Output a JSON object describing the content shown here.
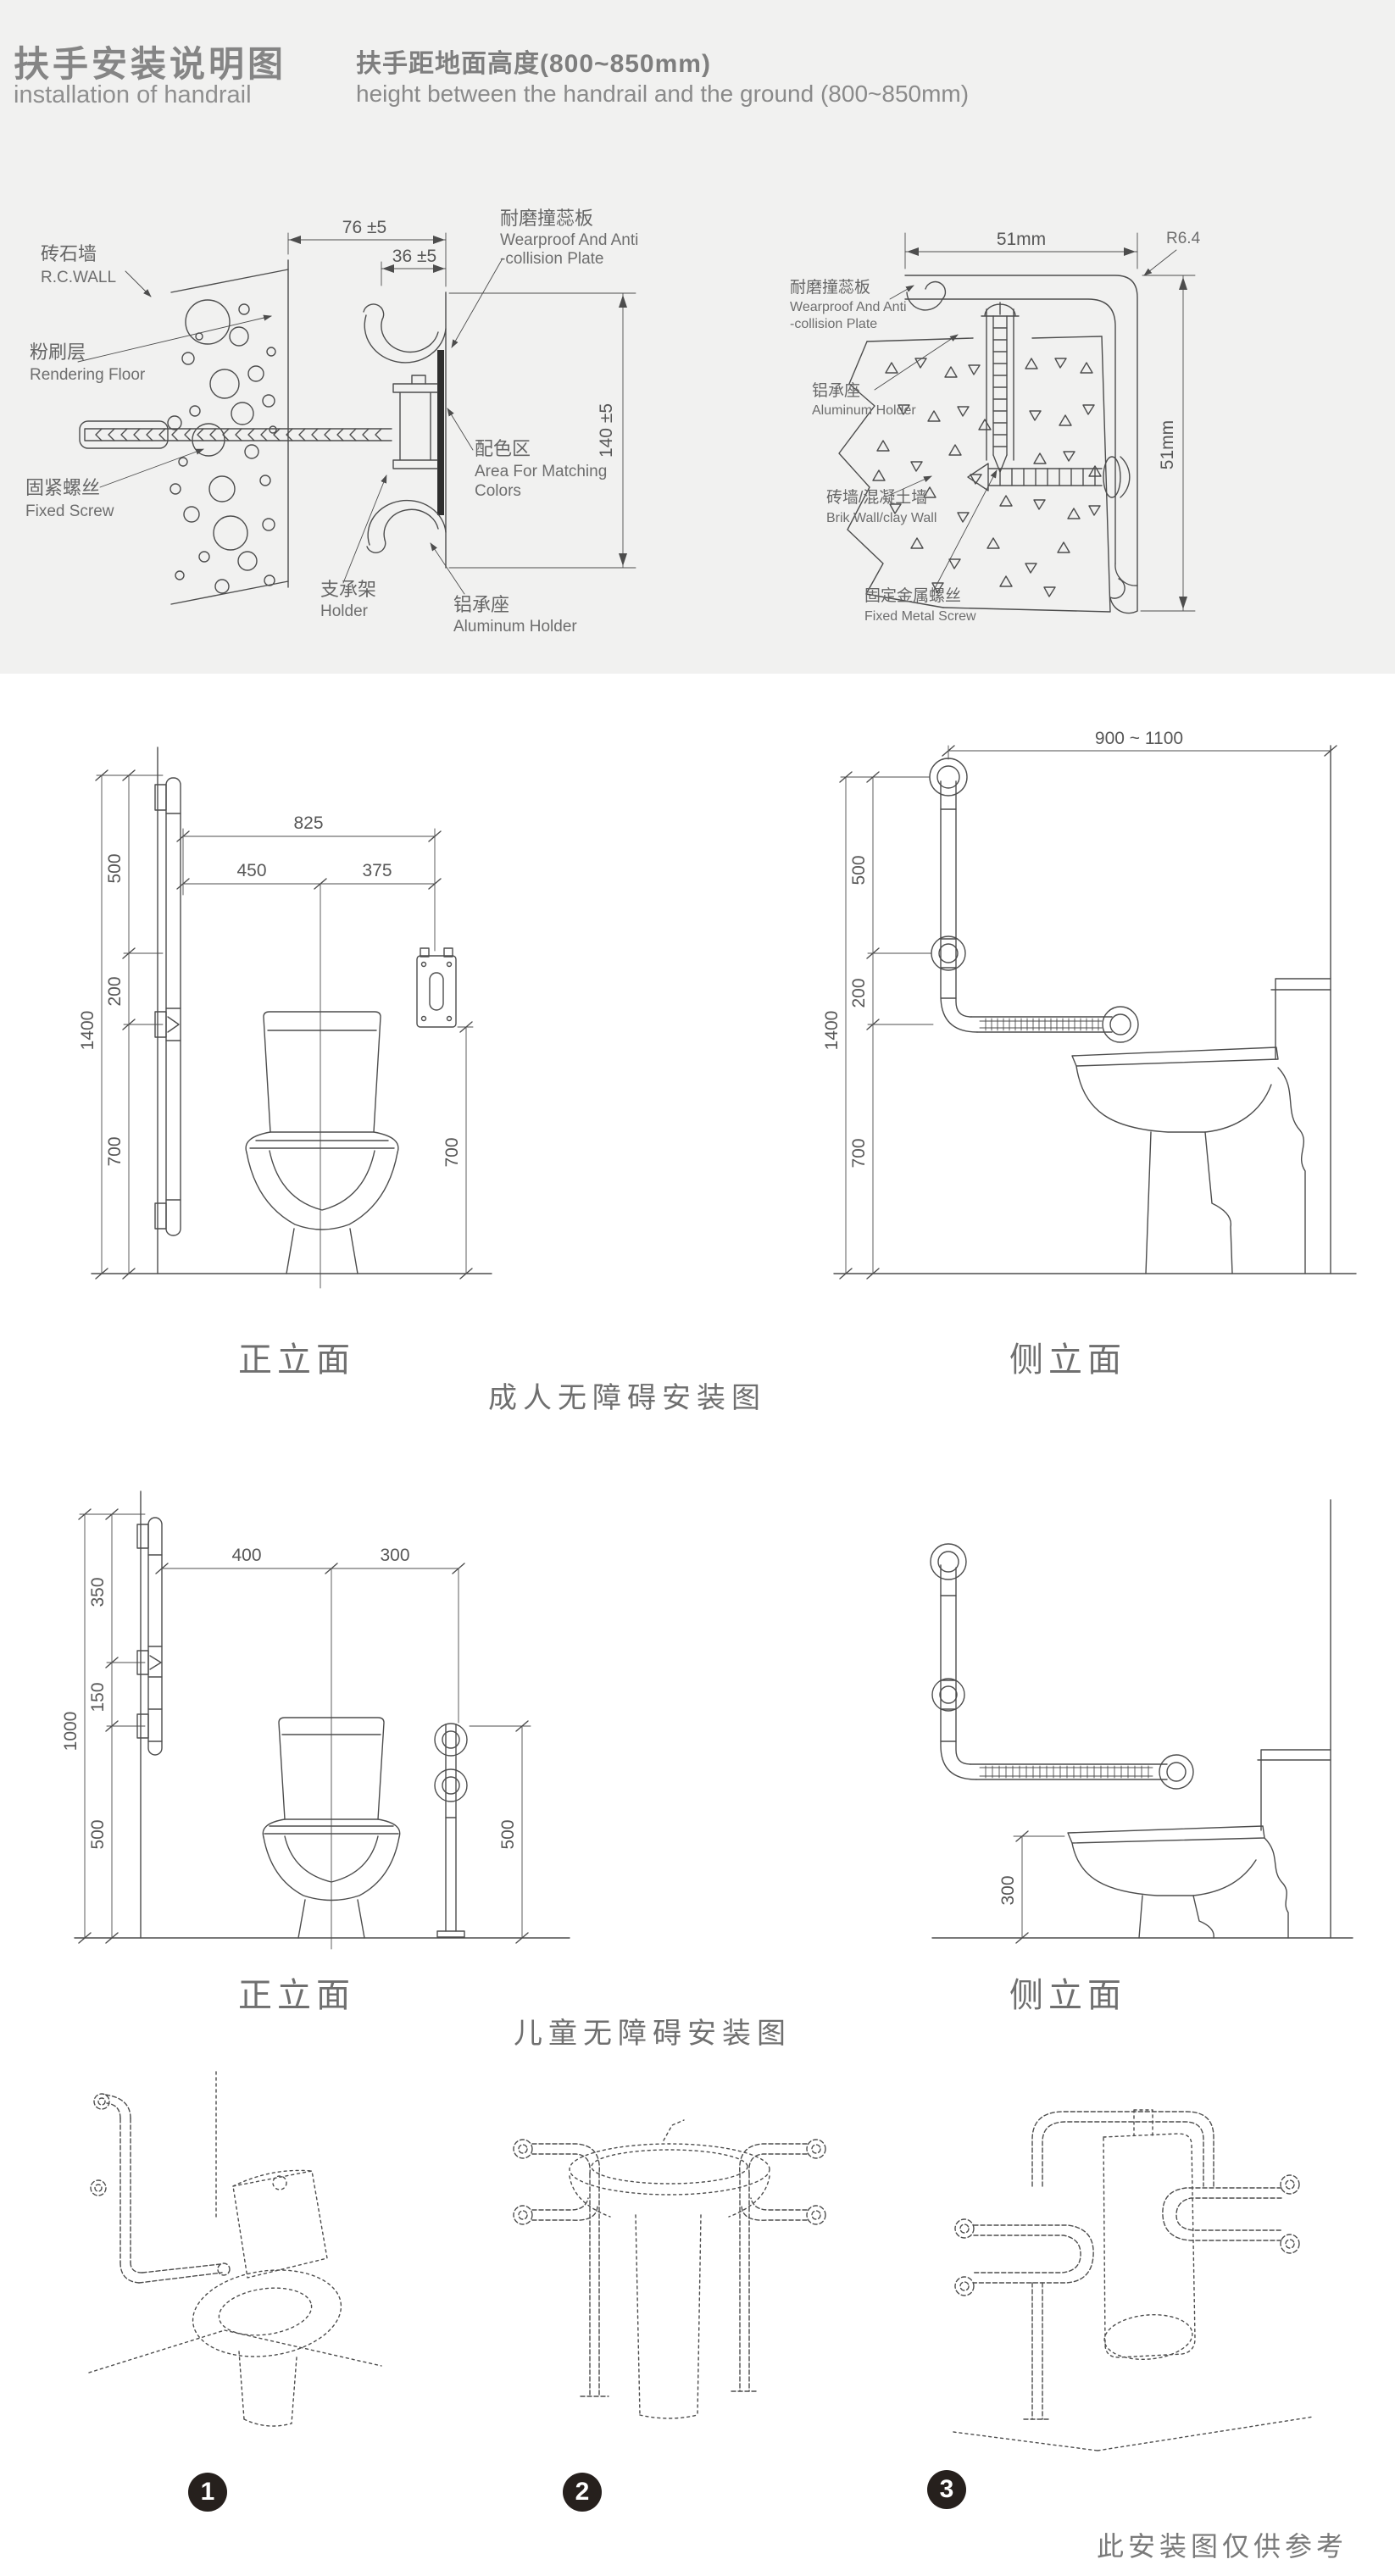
{
  "colors": {
    "band": "#f1f1f0",
    "line": "#4d4d4d",
    "label": "#666666",
    "badge": "#26201d"
  },
  "header": {
    "title_cn": "扶手安装说明图",
    "title_en": "installation of handrail",
    "subtitle_cn": "扶手距地面高度(800~850mm)",
    "subtitle_en": "height between the handrail and the ground (800~850mm)"
  },
  "profile_left": {
    "dim_width": "76 ±5",
    "dim_inner": "36 ±5",
    "dim_height": "140 ±5",
    "wall_cn": "砖石墙",
    "wall_en": "R.C.WALL",
    "render_cn": "粉刷层",
    "render_en": "Rendering Floor",
    "screw_cn": "固紧螺丝",
    "screw_en": "Fixed Screw",
    "holder_cn": "支承架",
    "holder_en": "Holder",
    "plate_cn": "耐磨撞蕊板",
    "plate_en1": "Wearproof And Anti",
    "plate_en2": "-collision Plate",
    "area_cn": "配色区",
    "area_en1": "Area For Matching",
    "area_en2": "Colors",
    "alu_cn": "铝承座",
    "alu_en": "Aluminum Holder"
  },
  "profile_right": {
    "dim_width": "51mm",
    "dim_radius": "R6.4",
    "dim_height": "51mm",
    "plate_cn": "耐磨撞蕊板",
    "plate_en1": "Wearproof And Anti",
    "plate_en2": "-collision Plate",
    "alu_cn": "铝承座",
    "alu_en": "Aluminum Holder",
    "wall_cn": "砖墙/混凝土墙",
    "wall_en": "Brik Wall/clay Wall",
    "screw_cn": "固定金属螺丝",
    "screw_en": "Fixed Metal Screw"
  },
  "adult": {
    "title": "成人无障碍安装图",
    "front_label": "正立面",
    "side_label": "侧立面",
    "front": {
      "d825": "825",
      "d450": "450",
      "d375": "375",
      "d500": "500",
      "d200": "200",
      "d1400": "1400",
      "d700l": "700",
      "d700r": "700"
    },
    "side": {
      "dspan": "900 ~ 1100",
      "d500": "500",
      "d200": "200",
      "d1400": "1400",
      "d700": "700"
    }
  },
  "child": {
    "title": "儿童无障碍安装图",
    "front_label": "正立面",
    "side_label": "侧立面",
    "front": {
      "d400": "400",
      "d300": "300",
      "d350": "350",
      "d150": "150",
      "d1000": "1000",
      "d500l": "500",
      "d500r": "500"
    },
    "side": {
      "d300": "300"
    }
  },
  "gallery": {
    "badges": [
      "1",
      "2",
      "3"
    ],
    "note": "此安装图仅供参考"
  }
}
